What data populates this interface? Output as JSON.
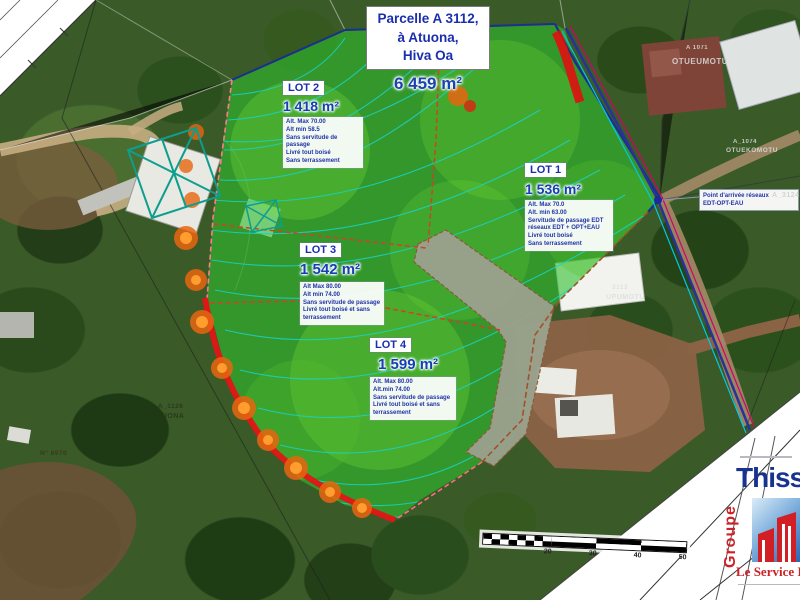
{
  "title_box": {
    "line1": "Parcelle A 3112,",
    "line2": "à Atuona,",
    "line3": "Hiva Oa"
  },
  "total_area": "6 459 m²",
  "lots": [
    {
      "name": "LOT 1",
      "area": "1 536 m²",
      "details": [
        "Alt. Max 70.0",
        "Alt. min 63.00",
        "Servitude de passage EDT",
        "réseaux EDT + OPT+EAU",
        "Livré tout boisé",
        "Sans terrassement"
      ]
    },
    {
      "name": "LOT 2",
      "area": "1 418 m²",
      "details": [
        "Alt. Max 70.00",
        "Alt min 58.5",
        "Sans servitude de passage",
        "Livré tout boisé",
        "Sans terrassement"
      ]
    },
    {
      "name": "LOT 3",
      "area": "1 542 m²",
      "details": [
        "Alt Max 80.00",
        "Alt min 74.00",
        "Sans servitude de passage",
        "Livré tout boisé et sans",
        "terrassement"
      ]
    },
    {
      "name": "LOT 4",
      "area": "1 599 m²",
      "details": [
        "Alt. Max 80.00",
        "Alt.min 74.00",
        "Sans servitude de passage",
        "Livré tout boisé et sans",
        "terrassement"
      ]
    }
  ],
  "network_point": {
    "lines": [
      "Point d'arrivée réseaux",
      "EDT-OPT-EAU"
    ]
  },
  "cadastre": {
    "a1071": "A 1071",
    "otueumotu": "OTUEUMOTU",
    "a1074": "A_1074",
    "otuekomotu": "OTUEKOMOTU",
    "a3124": "A_3124",
    "a3113": "3113",
    "upumotu": "UPUMOTU",
    "a1126": "A_1126",
    "atuona": "ATUONA",
    "n8970": "N° 8970"
  },
  "scale_bar": {
    "labels": [
      "20",
      "30",
      "40",
      "50"
    ]
  },
  "logo": {
    "brand": "Thisse",
    "group": "Groupe",
    "tagline": "Le Service Immo"
  },
  "colors": {
    "parcel_green": "#2fc02f",
    "contour_cyan": "#19d3c8",
    "boundary_red": "#e31515",
    "orange_trees": "#e8650f",
    "label_blue": "#1b2fae",
    "logo_blue": "#17338f",
    "logo_red": "#cc2127"
  }
}
